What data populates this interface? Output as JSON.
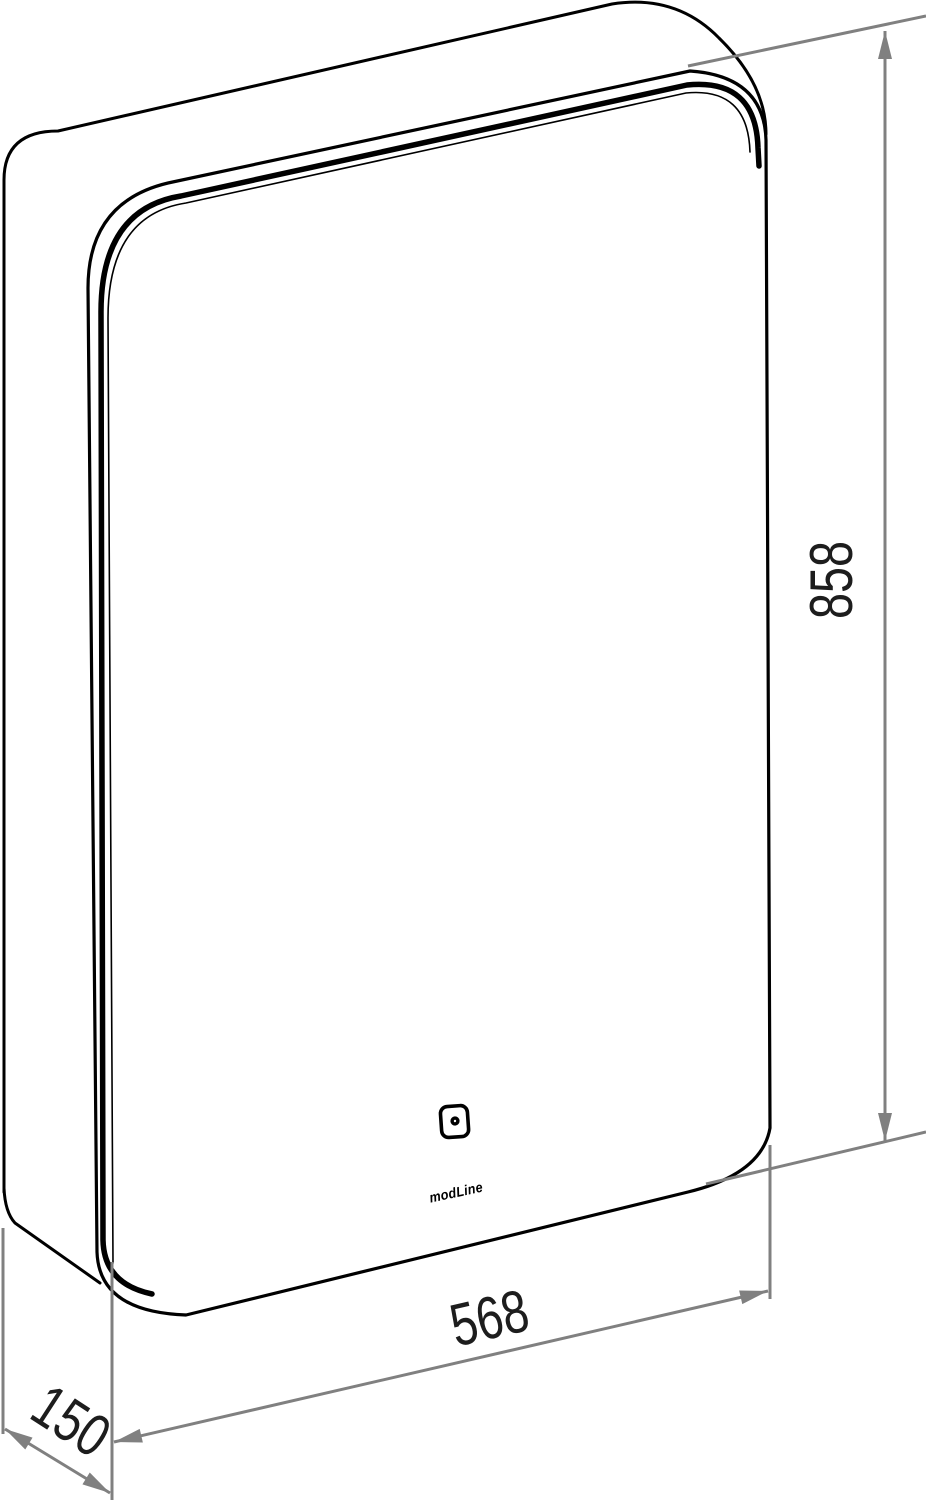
{
  "drawing": {
    "type": "technical-drawing",
    "subject": "wall mirror cabinet with LED strip and touch sensor, perspective view with dimensions",
    "dimensions": {
      "height": "858",
      "width": "568",
      "depth": "150"
    },
    "logo": "modLine",
    "icons": [
      "touch-sensor-icon"
    ],
    "colors": {
      "outline": "#000000",
      "dimension": "#808080",
      "dim_text": "#1d1d1d",
      "background": "#ffffff"
    }
  }
}
